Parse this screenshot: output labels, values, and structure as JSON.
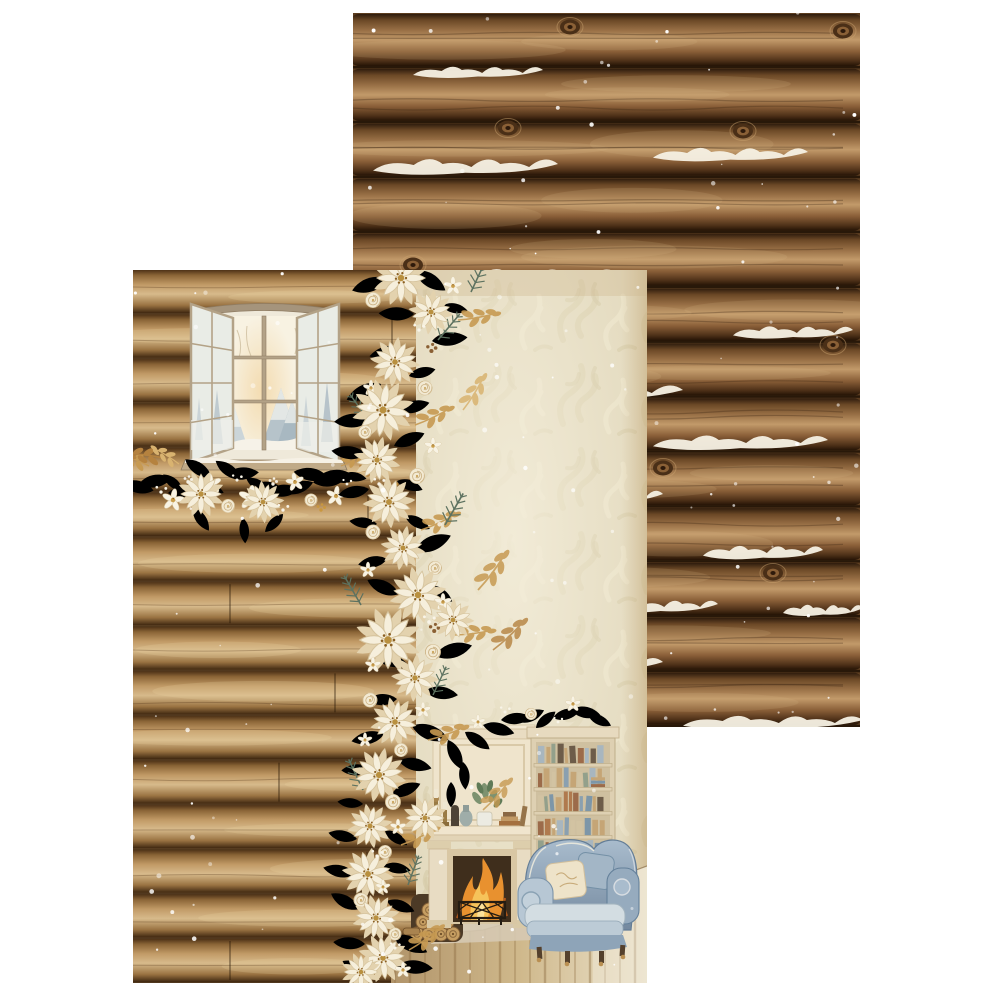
{
  "meta": {
    "kind": "product-photo",
    "description": "Two overlapping sheets of winter-themed decorative scrapbooking paper on a white background",
    "background_color": "#ffffff"
  },
  "back_sheet": {
    "description": "Scrapbook paper with stacked horizontal log-cabin wall texture, snow drifts on the logs, wood knots and falling snow specks",
    "position": {
      "left": 353,
      "top": 13,
      "width": 507,
      "height": 714
    },
    "palette": {
      "log_dark": "#2e1c0d",
      "log_mid": "#8a6038",
      "log_light": "#c29a6a",
      "seam": "#1f1206",
      "snow": "#f5efe2",
      "snow_dot": "#ffffff"
    }
  },
  "front_sheet": {
    "description": "Scrapbook paper collage of a cozy winter cabin: plank wall with an open window onto a snowy forest, cream and gold floral garland, damask wallpaper, fireplace with mantel decor, bookshelf with books, blue wingback armchair, stacked firewood and a plank floor",
    "position": {
      "left": 133,
      "top": 270,
      "width": 514,
      "height": 713
    },
    "palette": {
      "plank_light": "#d7ba8b",
      "plank_mid": "#a87f4e",
      "damask_base": "#e4dbc0",
      "damask_motif": "#dbd0ae",
      "flower_cream": "#f6efdc",
      "flower_shadow": "#e3d2ae",
      "gold_leaf": "#c79a52",
      "gold_leaf_dark": "#b5823f",
      "sage_leaf": "#9aa88d",
      "pine_leaf": "#5d7260",
      "blue_leaf": "#adb9c6",
      "berry_brown": "#8a5f33",
      "berry_gold": "#c9973f",
      "fire_orange": "#e8912f",
      "fire_gold": "#f6c35a",
      "chair_blue": "#8ba3b9",
      "cushion_cream": "#eee3c9",
      "fireplace_cream": "#efe4cc",
      "floor_tan": "#c9b183",
      "frame_tan": "#b3a287"
    }
  }
}
